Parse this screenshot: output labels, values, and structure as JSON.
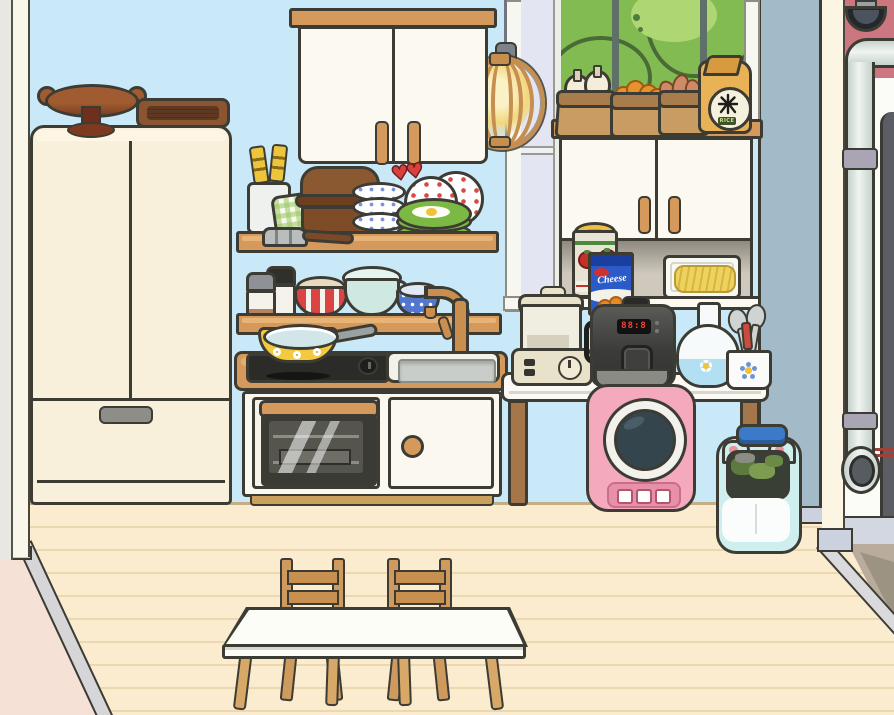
{
  "texts": {
    "rice_symbol": "米",
    "rice_label": "RICE",
    "cheese_box_label": "Cheese",
    "cooker_display": "88:8",
    "hearts_decor": "♥♥"
  },
  "palette": {
    "wall_blue": "#c9e9f8",
    "floor_cream": "#fbeccf",
    "wood": "#d59a5b",
    "outline": "#3c3c34",
    "corner_wall": "#a3bbc9",
    "side_wall_cream": "#fdf5e4",
    "back_wall_pink": "#cc7780",
    "washer_pink": "#f4a9bd",
    "bin_mint": "#cdeeee",
    "pan_yellow": "#f3ca3e",
    "rice_cooker_gray": "#464645",
    "tree_green": "#82bb52"
  },
  "inventory": [
    "refrigerator",
    "cake-stand",
    "serving-tray",
    "wall-cabinet",
    "pendant-lamp",
    "dish-shelf",
    "bowl-shelf",
    "stove-counter",
    "frying-pan",
    "sink",
    "faucet",
    "oven",
    "window",
    "tree-outside",
    "grocery-bag-garlic",
    "grocery-bag-carrots",
    "grocery-bag-potatoes",
    "rice-bag",
    "hutch-cabinet",
    "tomato-can",
    "cheese-box",
    "food-tray",
    "appliance-table",
    "blender",
    "rice-cooker",
    "flask-vase",
    "utensil-cup",
    "washing-machine",
    "pet-carrier-bin",
    "dining-table",
    "chair",
    "wall-pipe",
    "security-camera",
    "doorway"
  ]
}
